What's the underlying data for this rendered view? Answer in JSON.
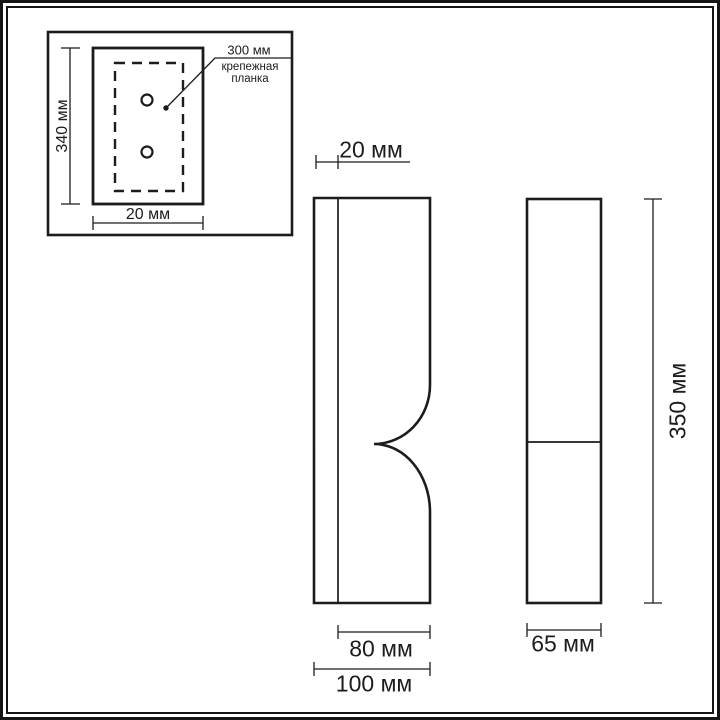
{
  "colors": {
    "line": "#1c1c1c",
    "frame": "#161616",
    "background": "#ffffff"
  },
  "inset": {
    "height_dim": "340 мм",
    "width_dim": "20 мм",
    "callout_dim": "300 мм",
    "callout_label": "крепежная планка"
  },
  "front_view": {
    "top_dim": "20 мм",
    "inner_width_dim": "80 мм",
    "outer_width_dim": "100 мм"
  },
  "side_view": {
    "width_dim": "65 мм",
    "height_dim": "350 мм"
  }
}
